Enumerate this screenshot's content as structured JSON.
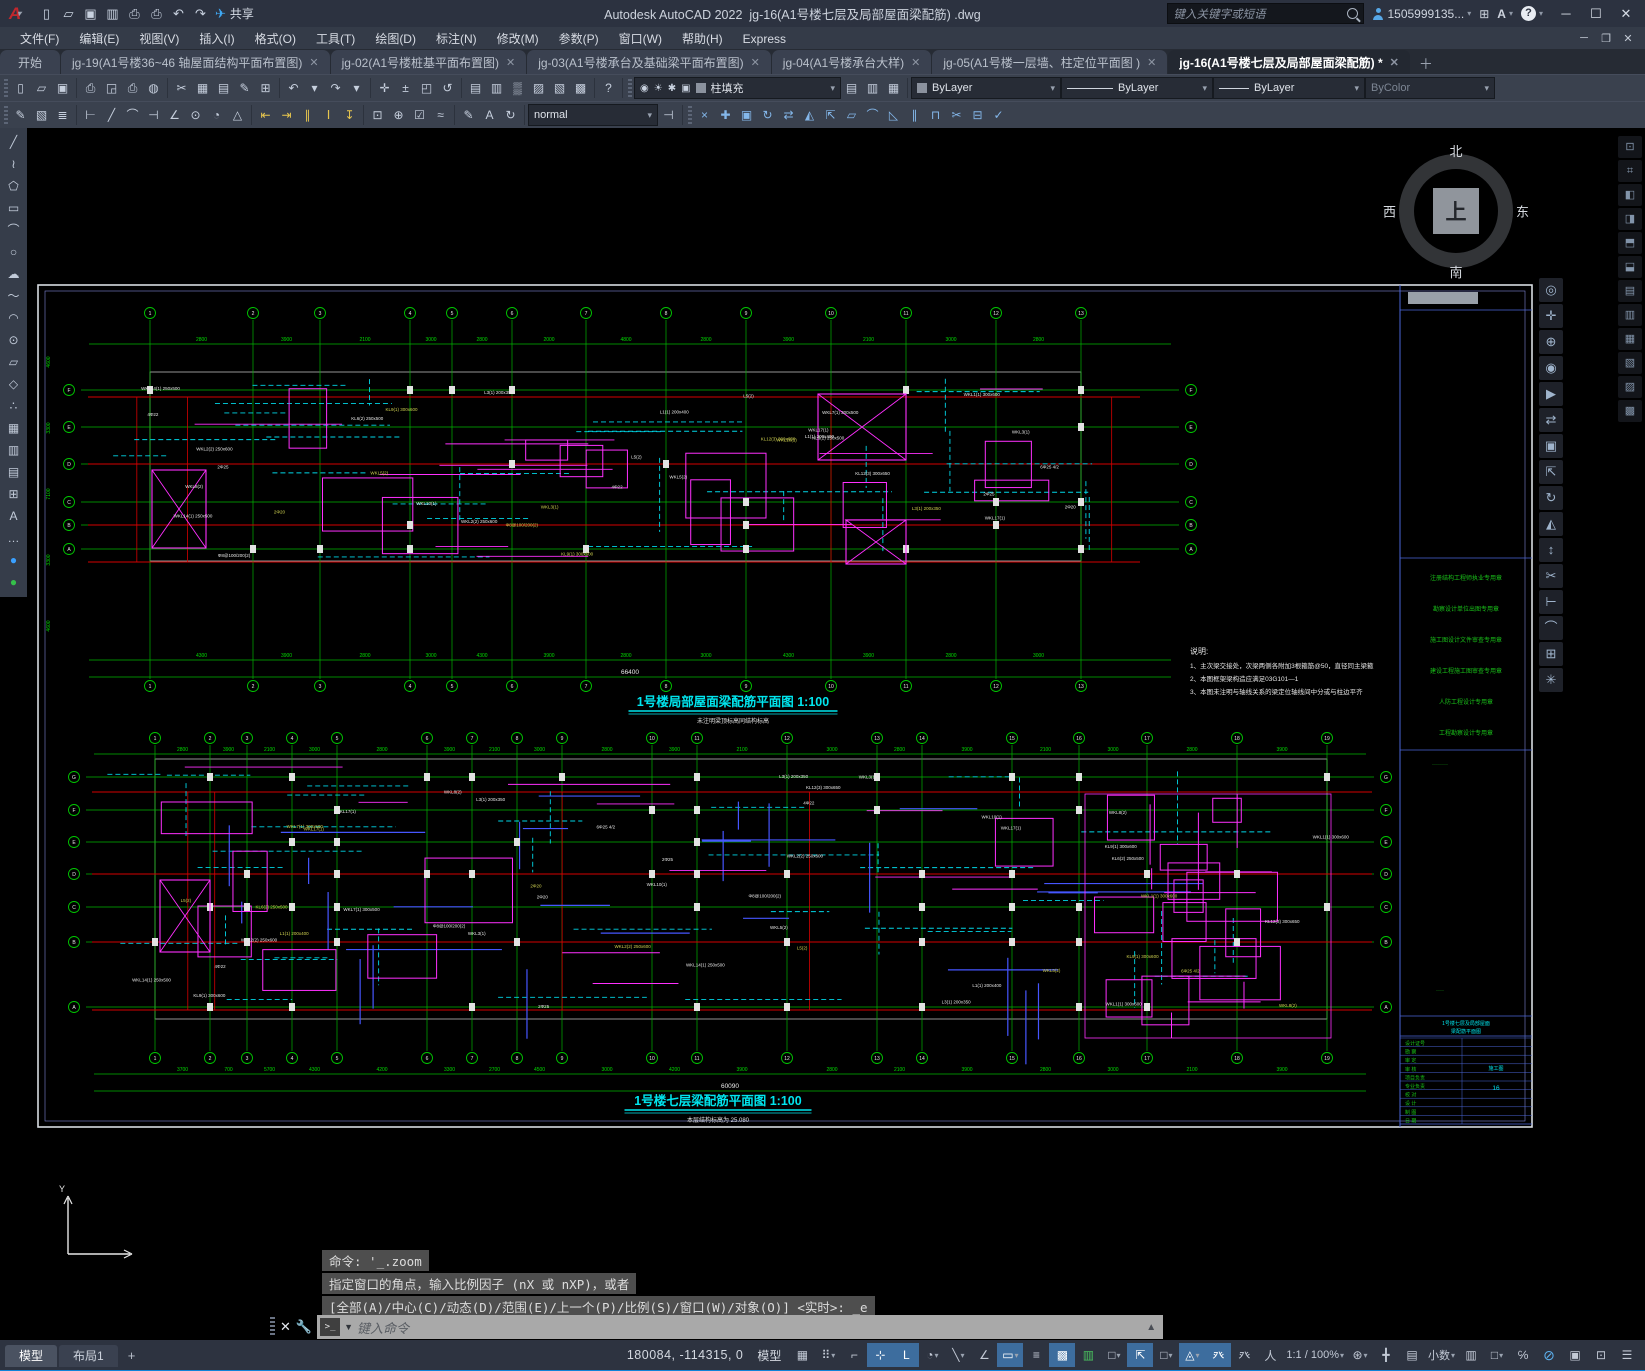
{
  "titlebar": {
    "app_title": "Autodesk AutoCAD 2022",
    "doc_title": "jg-16(A1号楼七层及局部屋面梁配筋)  .dwg",
    "search_placeholder": "键入关键字或短语",
    "user": "1505999135...",
    "share_label": "共享",
    "qat_icons": [
      [
        "new-file",
        "▯"
      ],
      [
        "open-file",
        "▱"
      ],
      [
        "save-file",
        "▣"
      ],
      [
        "save-as",
        "▥"
      ],
      [
        "plot",
        "⎙"
      ],
      [
        "print",
        "⎙"
      ],
      [
        "undo",
        "↶"
      ],
      [
        "redo",
        "↷"
      ]
    ],
    "window_controls": [
      "─",
      "☐",
      "✕"
    ]
  },
  "menu": {
    "items": [
      "文件(F)",
      "编辑(E)",
      "视图(V)",
      "插入(I)",
      "格式(O)",
      "工具(T)",
      "绘图(D)",
      "标注(N)",
      "修改(M)",
      "参数(P)",
      "窗口(W)",
      "帮助(H)",
      "Express"
    ],
    "doc_controls": [
      "─",
      "❐",
      "✕"
    ]
  },
  "tabs": {
    "items": [
      {
        "label": "开始",
        "close": false,
        "active": false,
        "start": true
      },
      {
        "label": "jg-19(A1号楼36~46 轴屋面结构平面布置图)",
        "close": true,
        "active": false
      },
      {
        "label": "jg-02(A1号楼桩基平面布置图)",
        "close": true,
        "active": false
      },
      {
        "label": "jg-03(A1号楼承台及基础梁平面布置图)",
        "close": true,
        "active": false
      },
      {
        "label": "jg-04(A1号楼承台大样)",
        "close": true,
        "active": false
      },
      {
        "label": "jg-05(A1号楼一层墙、柱定位平面图 )",
        "close": true,
        "active": false
      },
      {
        "label": "jg-16(A1号楼七层及局部屋面梁配筋) *",
        "close": true,
        "active": true
      }
    ]
  },
  "toolbars": {
    "row1_groups": [
      [
        [
          "new",
          "▯"
        ],
        [
          "open",
          "▱"
        ],
        [
          "save",
          "▣"
        ]
      ],
      [
        [
          "plot",
          "⎙"
        ],
        [
          "preview",
          "◲"
        ],
        [
          "publish",
          "⎙"
        ],
        [
          "etransmit",
          "◍"
        ]
      ],
      [
        [
          "cut",
          "✂"
        ],
        [
          "copy",
          "▦"
        ],
        [
          "paste",
          "▤"
        ],
        [
          "matchprop",
          "✎"
        ],
        [
          "edit",
          "⊞"
        ]
      ],
      [
        [
          "undo",
          "↶"
        ],
        [
          "undo-car",
          "▾"
        ],
        [
          "redo",
          "↷"
        ],
        [
          "redo-car",
          "▾"
        ]
      ],
      [
        [
          "pan",
          "✛"
        ],
        [
          "zoom-realtime",
          "±"
        ],
        [
          "zoom-window",
          "◰"
        ],
        [
          "zoom-previous",
          "↺"
        ]
      ],
      [
        [
          "properties",
          "▤"
        ],
        [
          "designcenter",
          "▥"
        ],
        [
          "toolpalettes",
          "▒"
        ],
        [
          "sheetset",
          "▨"
        ],
        [
          "markup",
          "▧"
        ],
        [
          "qcalc",
          "▩"
        ]
      ],
      [
        [
          "help",
          "?"
        ]
      ]
    ],
    "layer_cluster": [
      [
        "layer-on",
        "◉"
      ],
      [
        "layer-thaw",
        "☀"
      ],
      [
        "layer-freeze",
        "✱"
      ],
      [
        "layer-lock",
        "▣"
      ]
    ],
    "layer_dropdown": "柱填充",
    "layer_tools": [
      [
        "layer-prev",
        "▤"
      ],
      [
        "layer-match",
        "▥"
      ],
      [
        "layer-states",
        "▦"
      ]
    ],
    "color_dropdown": "ByLayer",
    "linetype_dropdown": "ByLayer",
    "lineweight_dropdown": "ByLayer",
    "plotstyle_dropdown": "ByColor",
    "row2_groups": [
      [
        [
          "dim-edit",
          "✎"
        ],
        [
          "dim-text",
          "▧"
        ],
        [
          "dim-style-mgr",
          "≣"
        ]
      ],
      [
        [
          "dim-linear",
          "⊢"
        ],
        [
          "dim-aligned",
          "╱"
        ],
        [
          "dim-arc",
          "⌒"
        ],
        [
          "dim-ordinate",
          "⊣"
        ],
        [
          "dim-angular",
          "∠"
        ],
        [
          "dim-radius",
          "⊙"
        ],
        [
          "dim-diameter",
          "◔"
        ],
        [
          "dim-jogged",
          "△"
        ]
      ],
      [
        [
          "dim-baseline",
          "⇤"
        ],
        [
          "dim-continue",
          "⇥"
        ],
        [
          "dim-space",
          "∥"
        ],
        [
          "dim-break",
          "Ⅰ"
        ],
        [
          "dim-update",
          "↧"
        ]
      ],
      [
        [
          "center-mark",
          "⊡"
        ],
        [
          "tolerance",
          "⊕"
        ],
        [
          "inspect",
          "☑"
        ],
        [
          "jog-line",
          "≈"
        ]
      ],
      [
        [
          "dim-edit2",
          "✎"
        ],
        [
          "dim-textedit",
          "A"
        ],
        [
          "dim-refresh",
          "↻"
        ]
      ]
    ],
    "dimstyle_dropdown": "normal",
    "row2_after": [
      [
        "dim-apply",
        "⊣"
      ]
    ],
    "modify_group": [
      [
        "erase",
        "×"
      ],
      [
        "move",
        "✚"
      ],
      [
        "copy",
        "▣"
      ],
      [
        "rotate",
        "↻"
      ],
      [
        "mirror",
        "⇄"
      ],
      [
        "scale",
        "◭"
      ],
      [
        "stretch",
        "⇱"
      ],
      [
        "array",
        "▱"
      ],
      [
        "fillet",
        "⌒"
      ],
      [
        "chamfer",
        "◺"
      ],
      [
        "offset",
        "∥"
      ],
      [
        "trim",
        "⊓"
      ],
      [
        "break",
        "✂"
      ],
      [
        "join",
        "⊟"
      ],
      [
        "explode",
        "✓"
      ]
    ]
  },
  "left_tools": {
    "icons": [
      [
        "line-tool",
        "╱"
      ],
      [
        "polyline-tool",
        "≀"
      ],
      [
        "polygon-tool",
        "⬠"
      ],
      [
        "rectangle-tool",
        "▭"
      ],
      [
        "arc-tool",
        "⌒"
      ],
      [
        "circle-tool",
        "○"
      ],
      [
        "revcloud-tool",
        "☁"
      ],
      [
        "spline-tool",
        "〜"
      ],
      [
        "ellipse-tool",
        "◠"
      ],
      [
        "ellipse-arc-tool",
        "⊙"
      ],
      [
        "insert-block-tool",
        "▱"
      ],
      [
        "make-block-tool",
        "◇"
      ],
      [
        "point-tool",
        "∴"
      ],
      [
        "hatch-tool",
        "▦"
      ],
      [
        "gradient-tool",
        "▥"
      ],
      [
        "region-tool",
        "▤"
      ],
      [
        "table-tool",
        "⊞"
      ],
      [
        "mtext-tool",
        "A"
      ],
      [
        "more-tool",
        "…"
      ]
    ],
    "color_dots": [
      [
        "blue-dot",
        "●"
      ],
      [
        "green-dot",
        "●"
      ]
    ]
  },
  "right_nav": [
    [
      "nav-wheel",
      "◎"
    ],
    [
      "pan-hand",
      "✛"
    ],
    [
      "zoom-plus",
      "⊕"
    ],
    [
      "orbit",
      "◉"
    ],
    [
      "showmotion",
      "▶"
    ],
    [
      "move",
      "⇄"
    ],
    [
      "copy",
      "▣"
    ],
    [
      "stretch",
      "⇱"
    ],
    [
      "rotate",
      "↻"
    ],
    [
      "mirror",
      "◭"
    ],
    [
      "scale",
      "↕"
    ],
    [
      "trim",
      "✂"
    ],
    [
      "extend",
      "⊢"
    ],
    [
      "fillet",
      "⌒"
    ],
    [
      "array",
      "⊞"
    ],
    [
      "explode",
      "✳"
    ]
  ],
  "far_right": [
    [
      "panel-1",
      "⊡"
    ],
    [
      "panel-2",
      "⌗"
    ],
    [
      "panel-3",
      "◧"
    ],
    [
      "panel-4",
      "◨"
    ],
    [
      "panel-5",
      "⬒"
    ],
    [
      "panel-6",
      "⬓"
    ],
    [
      "panel-7",
      "▤"
    ],
    [
      "panel-8",
      "▥"
    ],
    [
      "panel-9",
      "▦"
    ],
    [
      "panel-10",
      "▧"
    ],
    [
      "panel-11",
      "▨"
    ],
    [
      "panel-12",
      "▩"
    ]
  ],
  "compass": {
    "n": "北",
    "s": "南",
    "e": "东",
    "w": "西",
    "center": "上"
  },
  "command": {
    "history": [
      "命令: '_.zoom",
      "指定窗口的角点，输入比例因子 (nX 或 nXP)，或者",
      "[全部(A)/中心(C)/动态(D)/范围(E)/上一个(P)/比例(S)/窗口(W)/对象(O)] <实时>: _e"
    ],
    "prompt_icon": ">_",
    "placeholder": "键入命令"
  },
  "status": {
    "layout_tabs": [
      "模型",
      "布局1"
    ],
    "plus": "+",
    "coords": "180084, -114315, 0",
    "model_button": "模型",
    "icons": [
      {
        "n": "grid",
        "g": "▦"
      },
      {
        "n": "snap",
        "g": "⠿",
        "dd": 1
      },
      {
        "n": "infer",
        "g": "⌐"
      },
      {
        "n": "dyn-input",
        "g": "⊹",
        "on": 1
      },
      {
        "n": "ortho",
        "g": "L",
        "on": 1
      },
      {
        "n": "polar",
        "g": "◔",
        "dd": 1
      },
      {
        "n": "isodraft",
        "g": "╲",
        "dd": 1
      },
      {
        "n": "otrack",
        "g": "∠"
      },
      {
        "n": "osnap",
        "g": "▭",
        "on": 1,
        "dd": 1
      },
      {
        "n": "lineweight",
        "g": "≡"
      },
      {
        "n": "transparency",
        "g": "▩",
        "on": 1
      },
      {
        "n": "selection-cycling",
        "g": "▥",
        "green": 1
      },
      {
        "n": "3dosnap",
        "g": "□",
        "dd": 1
      },
      {
        "n": "dynamic-ucs",
        "g": "⇱",
        "on": 1
      },
      {
        "n": "selection-filter",
        "g": "□",
        "dd": 1
      },
      {
        "n": "gizmo",
        "g": "◬",
        "on": 1,
        "dd": 1
      },
      {
        "n": "annotation-vis",
        "g": "癶",
        "on": 1
      },
      {
        "n": "autoscale",
        "g": "癶"
      },
      {
        "n": "annotation",
        "g": "人"
      },
      {
        "n": "annotation-scale",
        "t": "1:1 / 100%",
        "dd": 1
      },
      {
        "n": "workspace",
        "g": "⊛",
        "dd": 1
      },
      {
        "n": "annotation-monitor",
        "g": "╋"
      },
      {
        "n": "units-icon",
        "g": "▤"
      },
      {
        "n": "units",
        "t": "小数",
        "dd": 1
      },
      {
        "n": "quick-properties",
        "g": "▥"
      },
      {
        "n": "lock-ui",
        "g": "□",
        "dd": 1
      },
      {
        "n": "isolate",
        "g": "℅"
      },
      {
        "n": "graphics-perf",
        "g": "⊘",
        "blue": 1
      },
      {
        "n": "clean-screen-check",
        "g": "▣"
      },
      {
        "n": "clean-screen",
        "g": "⊡"
      },
      {
        "n": "customize-menu",
        "g": "☰"
      }
    ]
  },
  "drawing": {
    "frame": {
      "x": 38,
      "y": 283,
      "w": 1494,
      "h": 842,
      "tb_x": 1400
    },
    "notes": {
      "x": 1190,
      "y": 652,
      "title": "说明:",
      "lines": [
        "1、主次梁交接处，次梁两侧各附加3根箍筋@50，直径同主梁箍",
        "2、本图框架梁构造应满足03G101—1",
        "3、本图未注明与轴线关系的梁定位轴线间中分或与柱边平齐"
      ]
    },
    "labels_pool": [
      "WKL1(1) 300x600",
      "WKL2(2) 250x600",
      "L1(1) 200x400",
      "WKL3(1)",
      "WKL5(2)",
      "KL6(2) 250x500",
      "WKL7(1) 300x500",
      "L3(1) 200x350",
      "WKL17(1)",
      "WKL10(1)",
      "KL12(3) 300x650",
      "L5(2)",
      "WKL14(1) 250x500",
      "WKL8(2)",
      "KL9(1) 300x600",
      "2Φ25",
      "4Φ22",
      "Φ8@100/200(2)",
      "2Φ20",
      "6Φ25 4/2"
    ],
    "titleblock": {
      "seal_lines": [
        "注册结构工程师执业专用章",
        "勘察设计单位出图专用章",
        "施工图设计文件审查专用章",
        "建设工程施工图审查专用章",
        "人防工程设计专用章",
        "工程勘察设计专用章"
      ],
      "table_rows": [
        "设计证号",
        "勘 察",
        "审 定",
        "审 核",
        "项目负责",
        "专业负责",
        "校 对",
        "设 计",
        "制 图",
        "日 期"
      ],
      "name_lines": [
        "1号楼七层及局部屋面",
        "梁配筋平面图"
      ],
      "stage_value": "施工图",
      "no_value": "16"
    },
    "plans": [
      {
        "name": "roof",
        "x0": 95,
        "x1": 1165,
        "bub_top": 311,
        "dim_top": 342,
        "dim_bot": 658,
        "total_y": 672,
        "bub_bot": 684,
        "vx": [
          150,
          253,
          320,
          410,
          452,
          512,
          586,
          666,
          746,
          831,
          906,
          996,
          1081
        ],
        "hy": [
          388,
          425,
          462,
          500,
          523,
          547
        ],
        "ax_left": [
          "F",
          "E",
          "D",
          "C",
          "B",
          "A"
        ],
        "axis_start": 1,
        "red_y": [
          395,
          462,
          523,
          560
        ],
        "red_x0": 88,
        "red_x1": 1140,
        "dims_top": [
          "2800",
          "3900",
          "2100",
          "3000",
          "2800",
          "2000",
          "4800",
          "2800",
          "3900",
          "2100",
          "3000",
          "2800"
        ],
        "dims_bottom": [
          "4300",
          "3900",
          "2800",
          "3000",
          "4300",
          "3900",
          "2800",
          "3000",
          "4300",
          "3900",
          "2800",
          "3000"
        ],
        "total": "66400",
        "left_dims": [
          "4600",
          "3300",
          "7100",
          "3300",
          "4600"
        ],
        "left_dims_x": 50,
        "left_dims_y0": 360,
        "left_dims_dy": 66,
        "crosses": [
          {
            "x": 152,
            "y": 468,
            "w": 54,
            "h": 78
          },
          {
            "x": 818,
            "y": 392,
            "w": 88,
            "h": 66
          },
          {
            "x": 846,
            "y": 518,
            "w": 60,
            "h": 44
          }
        ],
        "magN": 12,
        "cyanN": 20,
        "blueN": 0,
        "labN": 36,
        "seed": 7,
        "title": "1号楼局部屋面梁配筋平面图 1:100",
        "subtitle": "未注明梁顶标高同结构标高",
        "title_cx": 733,
        "title_y": 704
      },
      {
        "name": "seven",
        "x0": 100,
        "x1": 1360,
        "bub_top": 736,
        "dim_top": 752,
        "dim_bot": 1072,
        "total_y": 1086,
        "bub_bot": 1056,
        "vx": [
          155,
          210,
          247,
          292,
          337,
          427,
          472,
          517,
          562,
          652,
          697,
          787,
          877,
          922,
          1012,
          1079,
          1147,
          1237,
          1327
        ],
        "hy": [
          775,
          808,
          840,
          872,
          905,
          940,
          1005
        ],
        "ax_left": [
          "G",
          "F",
          "E",
          "D",
          "C",
          "B",
          "A"
        ],
        "axis_start": 1,
        "red_y": [
          790,
          872,
          940,
          1008
        ],
        "red_x0": 92,
        "red_x1": 1372,
        "dims_top": [
          "2800",
          "3900",
          "2100",
          "3000",
          "2800",
          "3900",
          "2100",
          "3000",
          "2800",
          "3900",
          "2100",
          "3000",
          "2800",
          "3900",
          "2100",
          "3000",
          "2800",
          "3900"
        ],
        "dims_bottom": [
          "3700",
          "700",
          "5700",
          "4300",
          "4200",
          "3300",
          "2700",
          "4500",
          "3000",
          "4200",
          "3900",
          "2800",
          "2100",
          "3900",
          "2800",
          "3000",
          "2100",
          "3900"
        ],
        "total": "60090",
        "left_dims": [],
        "left_dims_x": 0,
        "left_dims_y0": 0,
        "left_dims_dy": 0,
        "crosses": [
          {
            "x": 160,
            "y": 878,
            "w": 50,
            "h": 72
          }
        ],
        "magN": 10,
        "cyanN": 26,
        "blueN": 30,
        "labN": 46,
        "seed": 13,
        "cluster": {
          "x": 1085,
          "y": 792,
          "w": 246,
          "h": 244,
          "rects": 10,
          "lines": 10
        },
        "title": "1号楼七层梁配筋平面图 1:100",
        "subtitle": "本层结构标高为 25.080",
        "title_cx": 718,
        "title_y": 1103
      }
    ]
  }
}
